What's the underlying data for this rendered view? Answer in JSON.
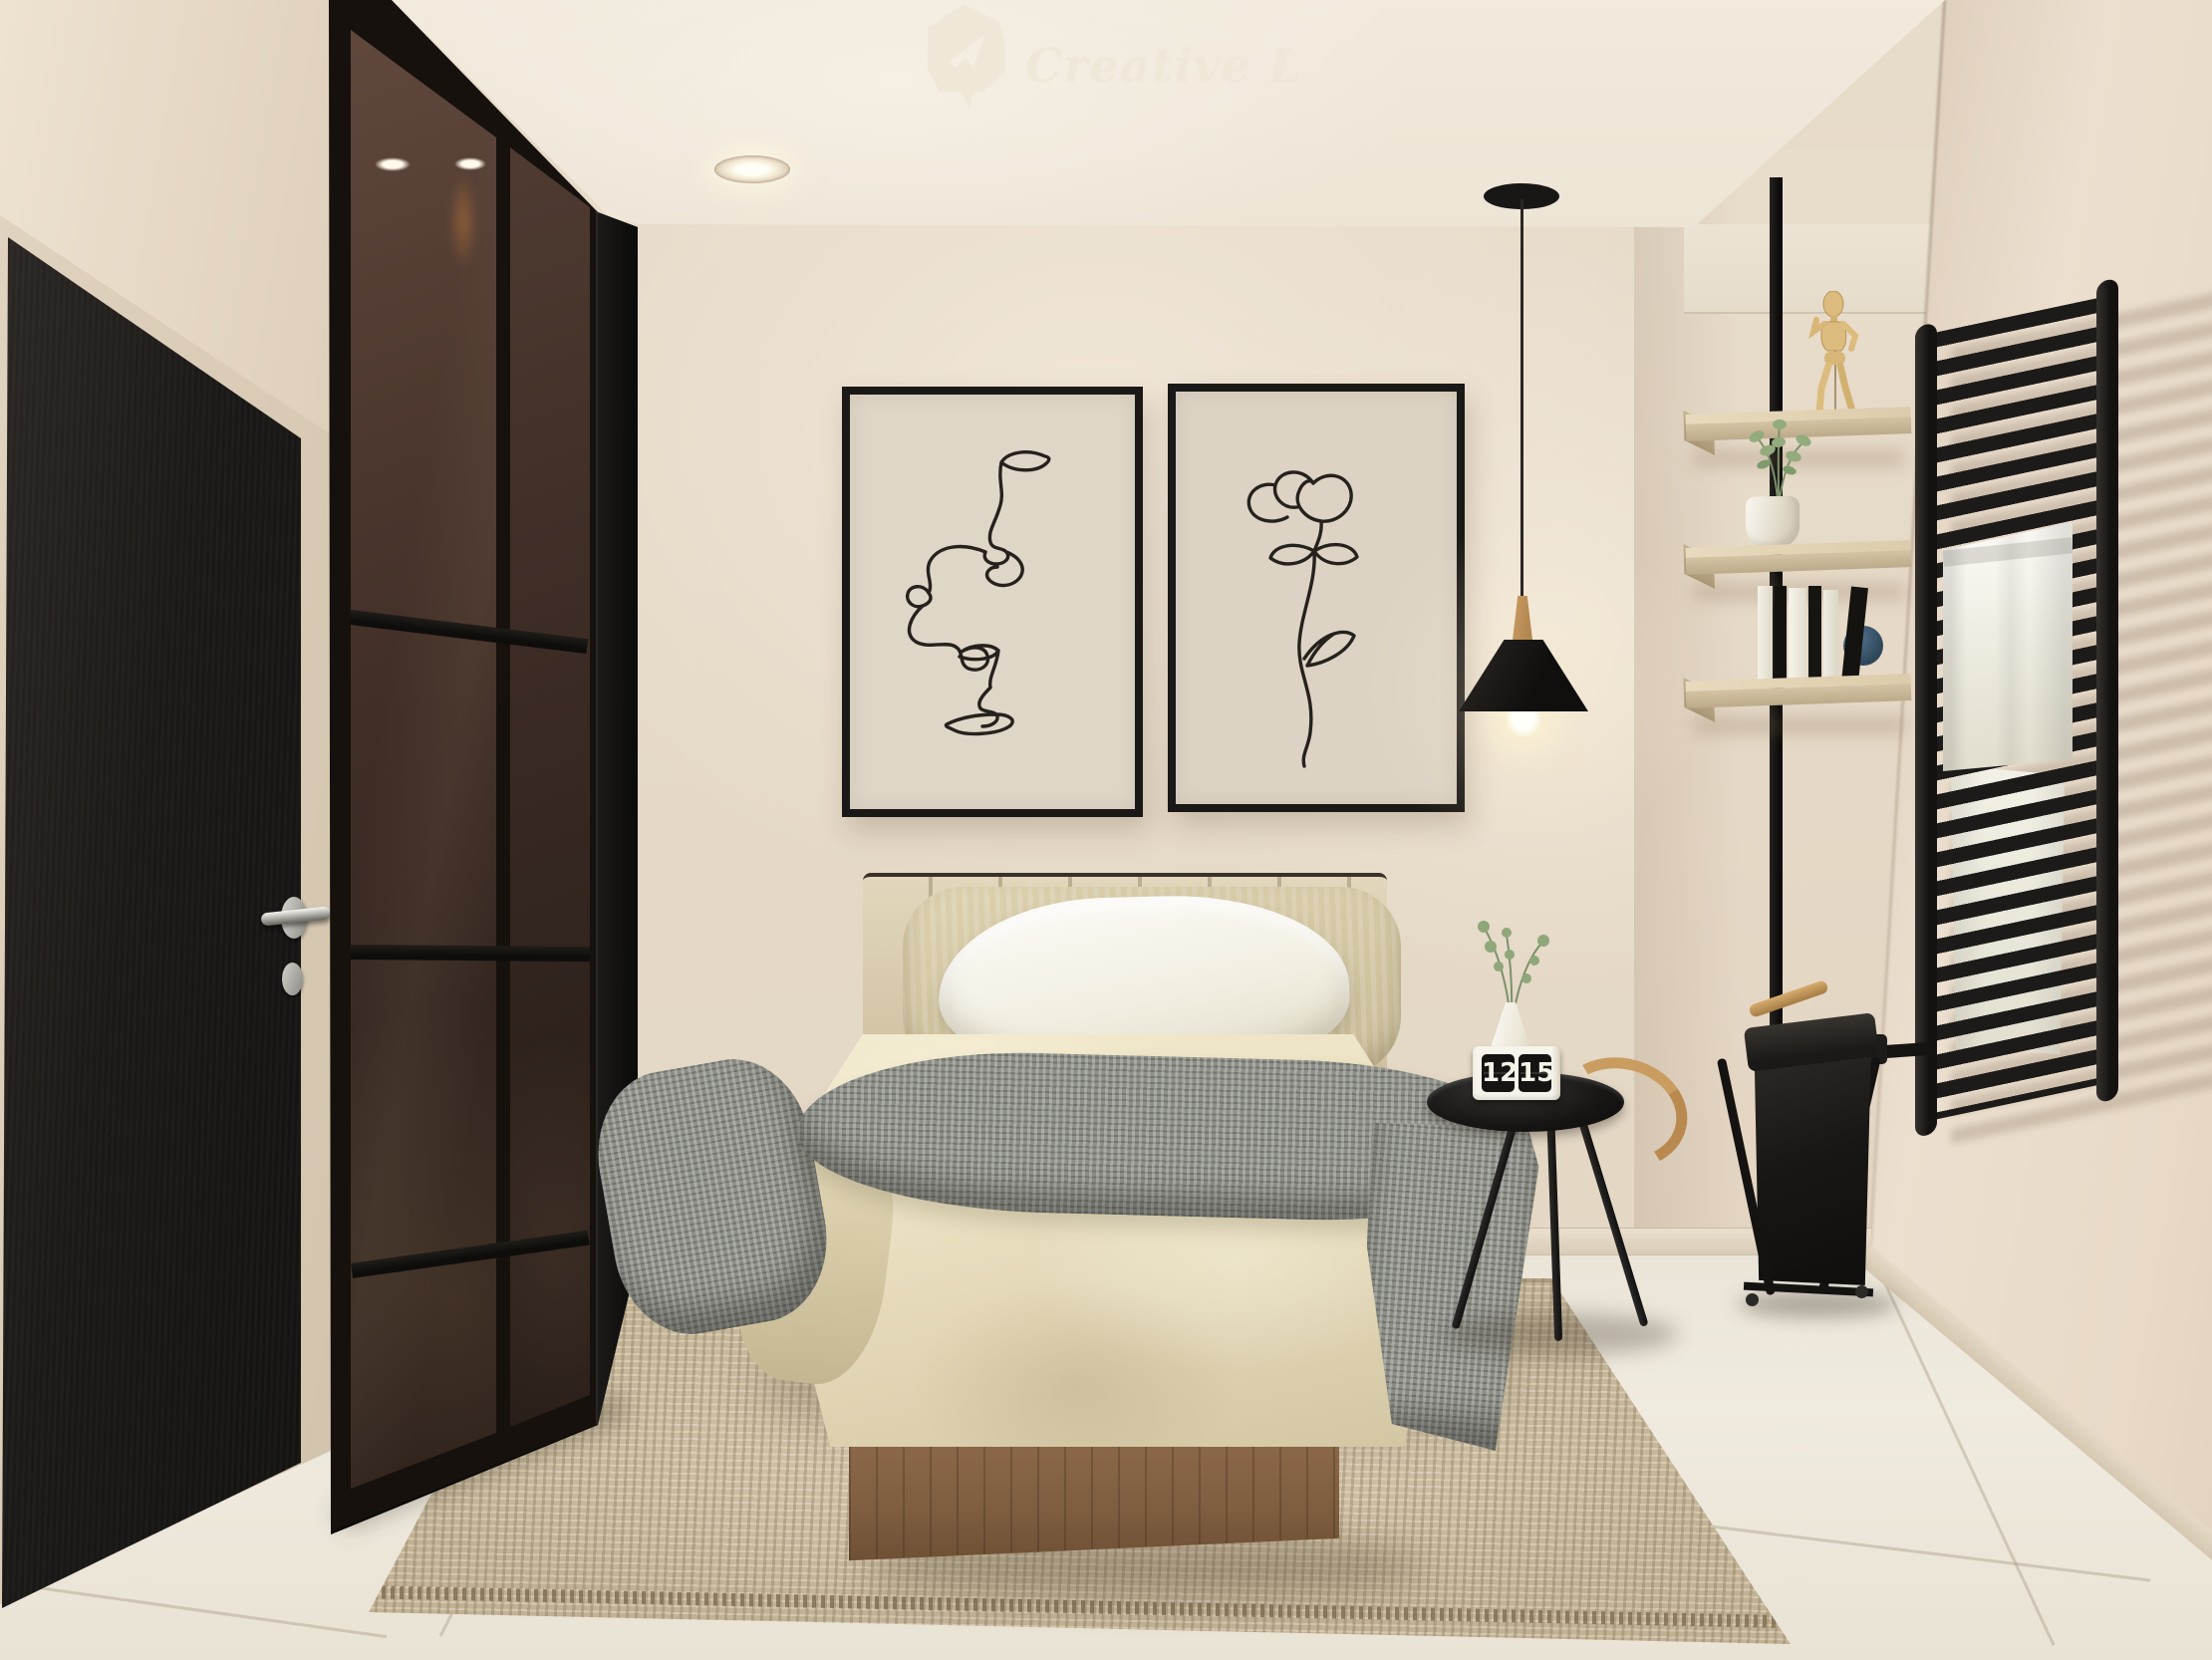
{
  "meta": {
    "description": "3D interior render of a minimalist beige and black bedroom",
    "room": "bedroom"
  },
  "watermark": {
    "brand": "Creative Lab",
    "icon": "paper-plane-badge-icon"
  },
  "flip_clock": {
    "hours": "12",
    "minutes": "15"
  },
  "palette": {
    "wall": "#e8dccc",
    "wallShade": "#e2d4c2",
    "ceiling": "#f1eadd",
    "floor": "#efeade",
    "rug": "#cdbfa3",
    "black": "#161513",
    "glassBrown": "#433028",
    "doorBlack": "#1b1917",
    "shelfWood": "#d4c3a4",
    "bedWood": "#82603f",
    "duvetCream": "#eadfc0",
    "pillowWhite": "#f7f4ec",
    "throwGray": "#8e9089",
    "towelWhite": "#f1efe4",
    "accentWood": "#b98a50",
    "mannequin": "#dcbc7e",
    "plantGreen": "#8aa173",
    "logoCream": "#efe8d8",
    "bulbGlow": "#fff4d2"
  }
}
